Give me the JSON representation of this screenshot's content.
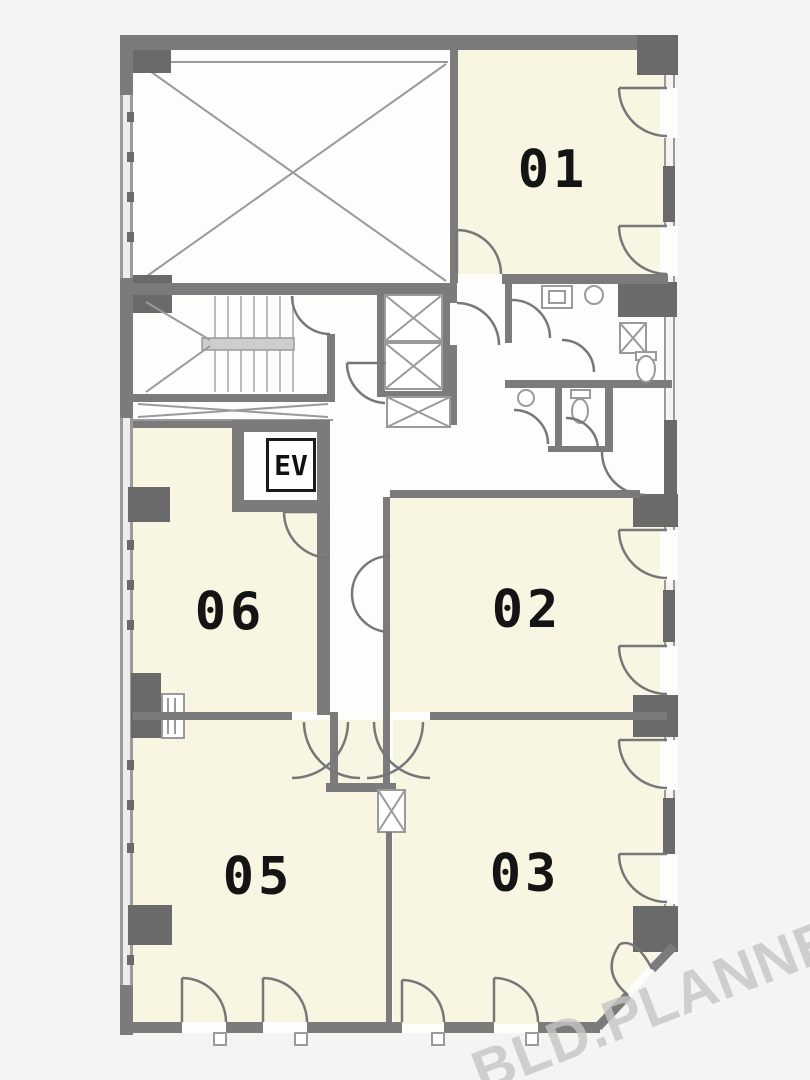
{
  "plan": {
    "rooms": [
      {
        "id": "room-01",
        "label": "01"
      },
      {
        "id": "room-02",
        "label": "02"
      },
      {
        "id": "room-03",
        "label": "03"
      },
      {
        "id": "room-05",
        "label": "05"
      },
      {
        "id": "room-06",
        "label": "06"
      }
    ],
    "elevator_label": "EV",
    "watermark": "BLD.PLANNER",
    "colors": {
      "page_bg": "#f4f4f2",
      "plan_bg": "#fdfdfc",
      "room_fill": "#f8f6e2",
      "wall": "#7b7b7b",
      "wall_dark": "#6a6a6a",
      "line": "#9a9a9a",
      "label_text": "#141414",
      "watermark_text": "#c5c5c5"
    }
  }
}
